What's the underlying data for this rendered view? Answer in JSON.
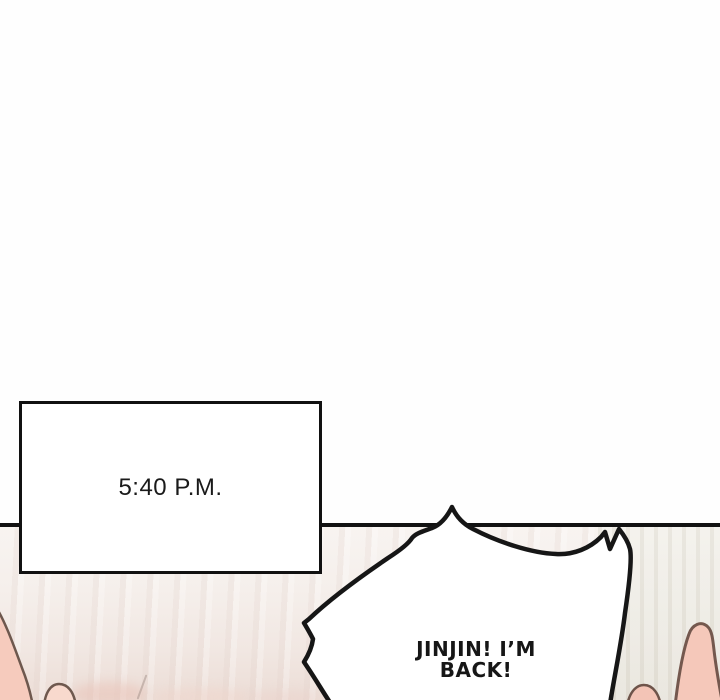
{
  "panel": {
    "time_caption": "5:40 P.M.",
    "speech": {
      "line1": "JINJIN! I’M",
      "line2": "BACK!"
    }
  },
  "colors": {
    "ink": "#161616",
    "paper": "#fefefe",
    "floor_light": "#f5efeb",
    "floor_pink": "#ecddd6",
    "wall_right": "#eae7df",
    "skin": "#f5c8ba",
    "skin_highlight": "#f8d9cd",
    "skin_outline": "#74584e"
  }
}
